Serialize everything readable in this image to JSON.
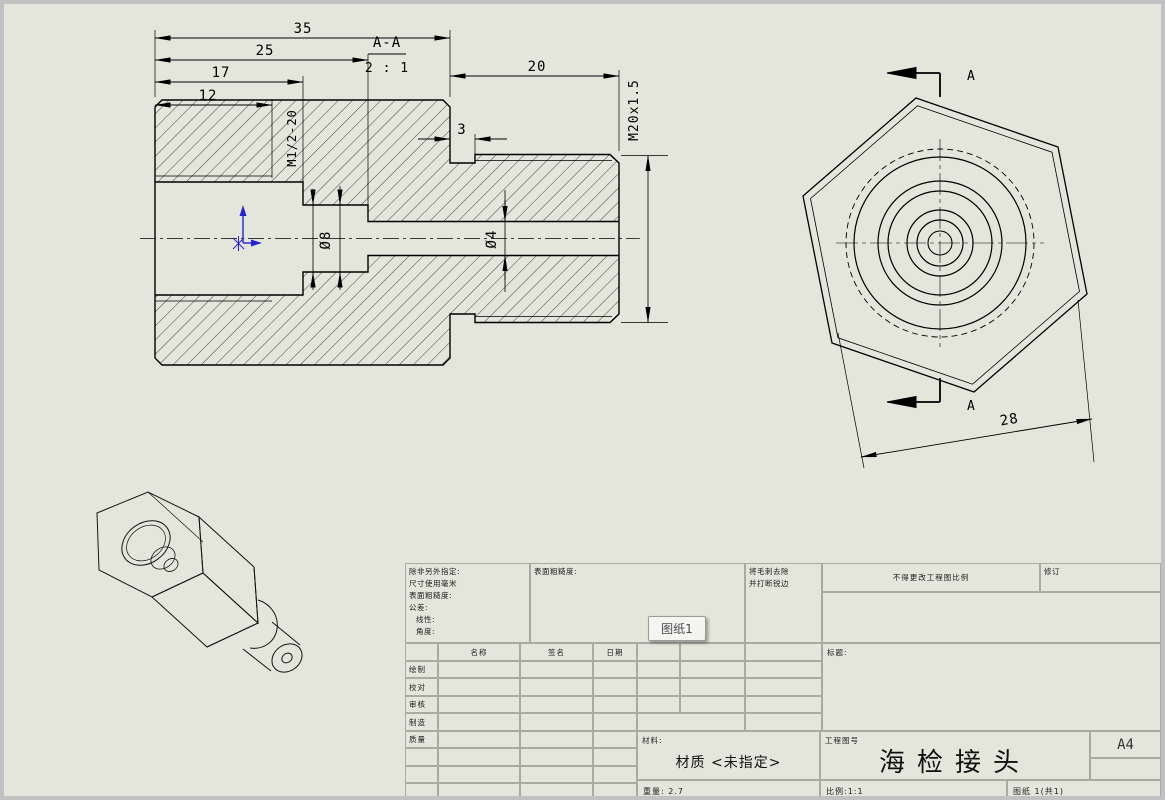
{
  "drawing": {
    "dims": {
      "len35": "35",
      "len25": "25",
      "len17": "17",
      "len12": "12",
      "len20": "20",
      "groove3": "3",
      "across28": "28",
      "dia8": "Ø8",
      "dia4": "Ø4",
      "thread_ext": "M20x1.5",
      "thread_int": "M1/2-20"
    },
    "section": {
      "label": "A-A",
      "scale": "2 : 1",
      "arrow_top": "A",
      "arrow_bottom": "A"
    }
  },
  "title_block": {
    "notes": {
      "l1": "除非另外指定:",
      "l2": "尺寸使用毫米",
      "l3": "表面粗糙度:",
      "l4": "公差:",
      "l5": "线性:",
      "l6": "角度:"
    },
    "finish_label": "表面粗糙度:",
    "deburr": {
      "l1": "将毛刺去除",
      "l2": "并打断锐边"
    },
    "do_not_scale": "不得更改工程图比例",
    "revision_label": "修订",
    "table": {
      "headers": [
        "名称",
        "签名",
        "日期"
      ],
      "rows": [
        "绘制",
        "校对",
        "审核",
        "制造",
        "质量"
      ]
    },
    "title_label": "标题:",
    "material_label": "材料:",
    "material_value": "材质 <未指定>",
    "weight_text": "重量: 2.7",
    "dwg_no_label": "工程图号",
    "part_title": "海检接头",
    "paper_size": "A4",
    "scale_text": "比例:1:1",
    "sheet_text": "图纸 1(共1)"
  },
  "tooltip": {
    "text": "图纸1"
  },
  "colors": {
    "paper": "#e4e5db",
    "frame": "#c0c1c3",
    "grid": "#a9aaa2",
    "line": "#000000",
    "origin_blue": "#2323d6"
  }
}
